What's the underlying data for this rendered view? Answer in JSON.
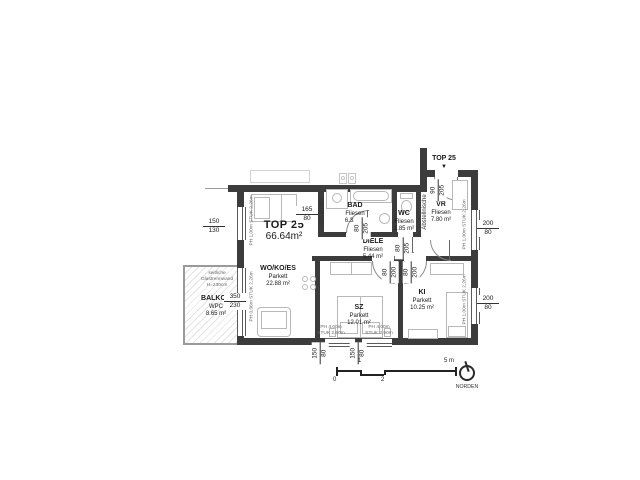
{
  "drawing": {
    "unit": {
      "title": "TOP 25",
      "area": "66.64m²"
    },
    "entrance": {
      "label": "TOP 25",
      "arrow": "▼"
    },
    "rooms": {
      "wo": {
        "name": "WO/KO/ES",
        "floor": "Parkett",
        "area": "22.88 m²"
      },
      "sz": {
        "name": "SZ",
        "floor": "Parkett",
        "area": "12.01 m²"
      },
      "ki": {
        "name": "KI",
        "floor": "Parkett",
        "area": "10.25 m²"
      },
      "bad": {
        "name": "BAD",
        "floor": "Fliesen",
        "area": "6.32 m²"
      },
      "wc": {
        "name": "WC",
        "floor": "Fliesen",
        "area": "1.85 m²"
      },
      "vr": {
        "name": "VR",
        "floor": "Fliesen",
        "area": "7.80 m²"
      },
      "diele": {
        "name": "DIELE",
        "floor": "Fliesen",
        "area": "5.44 m²"
      },
      "balkon": {
        "name": "BALKON",
        "floor": "WPC",
        "area": "8.65 m²"
      }
    },
    "niche": "Abstellnische",
    "shower": "DU 90/90",
    "glass_note": {
      "l1": "seitliche",
      "l2": "Glastrennwand",
      "l3": "H=230cm"
    },
    "dims": {
      "left_window": {
        "w": "150",
        "h": "130"
      },
      "balcony_door": {
        "w": "350",
        "h": "230"
      },
      "wo_opening": {
        "w": "165",
        "h": "80"
      },
      "entrance_door": {
        "w": "90",
        "h": "205"
      },
      "bad_door": {
        "w": "80",
        "h": "205"
      },
      "wc_door": {
        "w": "80",
        "h": "205"
      },
      "sz_door": {
        "w": "80",
        "h": "200"
      },
      "ki_door": {
        "w": "80",
        "h": "200"
      },
      "vr_window": {
        "w": "200",
        "h": "80"
      },
      "ki_window": {
        "w": "200",
        "h": "80"
      },
      "sz_window1": {
        "w": "150",
        "h": "80"
      },
      "sz_window2": {
        "w": "150",
        "h": "80"
      }
    },
    "notes": {
      "left_window": "PH 1,00m  STUK 2,26m",
      "balcony_door": "PH 0,06m  STUK 2,26m",
      "vr_window": "PH 1,00m  STUK 2,26m",
      "ki_window": "PH 1,00m  STUK 2,26m",
      "sz_window1_l1": "PH 4,00m",
      "sz_window1_l2": "STUK 2,50m",
      "sz_window2_l1": "PH 4,00m",
      "sz_window2_l2": "STUK 2,50m"
    },
    "scalebar": {
      "t0": "0",
      "t1": "1",
      "t2": "2",
      "t5": "5 m"
    },
    "north": "NORDEN",
    "colors": {
      "wall": "#3c3c3c",
      "furniture": "#b8b8b8",
      "text": "#1a1a1a"
    }
  }
}
